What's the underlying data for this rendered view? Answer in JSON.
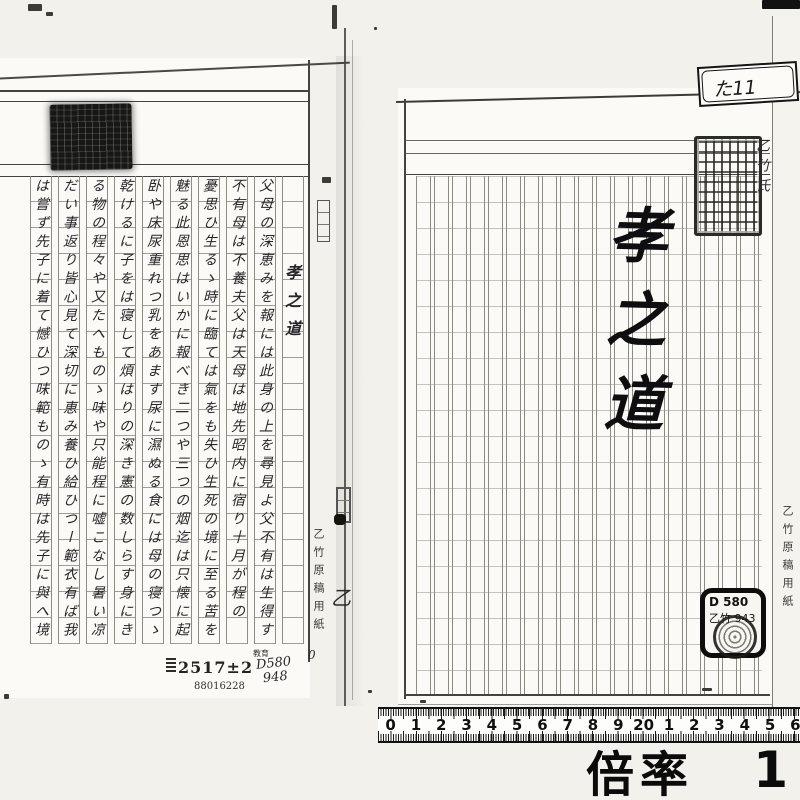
{
  "left_page": {
    "title": "孝之道",
    "columns": [
      "父母の深恵みを報には此身の上を尋見よ父不有は生得す",
      "不有母は不養夫父は天母は地先昭内に宿り十月が程の",
      "憂思ひ生るゝ時に臨ては氣をも失ひ生死の境に至る苦を",
      "魅る此恩思はいかに報べき二つや三つの烟迄は只懐に起",
      "卧や床尿重れつ乳をあます尿に濕ぬる食には母の寝つゝ",
      "乾けるに子をは寝して煩はりの深き憲の数しらす身にき",
      "る物の程々や又たへものゝ味や只能程に嘘こなし暑い凉",
      "だい事返り皆心見て深切に恵み養ひ給ひつー範衣有ば我",
      "は嘗ず先子に着て憾ひつ味範ものゝ有時は先子に與へ境"
    ],
    "stamp_number": "2517±2",
    "serial_number": "88016228",
    "class_stamp": "教育",
    "pencil_call_number": "D580",
    "pencil_number": "948"
  },
  "gutter": {
    "brand_text": "乙竹原稿用紙",
    "hand_character": "乙",
    "hand_zero": "0"
  },
  "right_page": {
    "tab_label": "た11",
    "title": "孝之道",
    "owner_text": "乙竹氏",
    "call_label_line1": "D 580",
    "call_label_line2": "乙竹 943",
    "edge_brand_text": "乙竹原稿用紙"
  },
  "footer": {
    "ruler_labels": [
      "0",
      "1",
      "2",
      "3",
      "4",
      "5",
      "6",
      "7",
      "8",
      "9",
      "20",
      "1",
      "2",
      "3",
      "4",
      "5",
      "6"
    ],
    "magnification_label": "倍率",
    "magnification_value": "1"
  }
}
